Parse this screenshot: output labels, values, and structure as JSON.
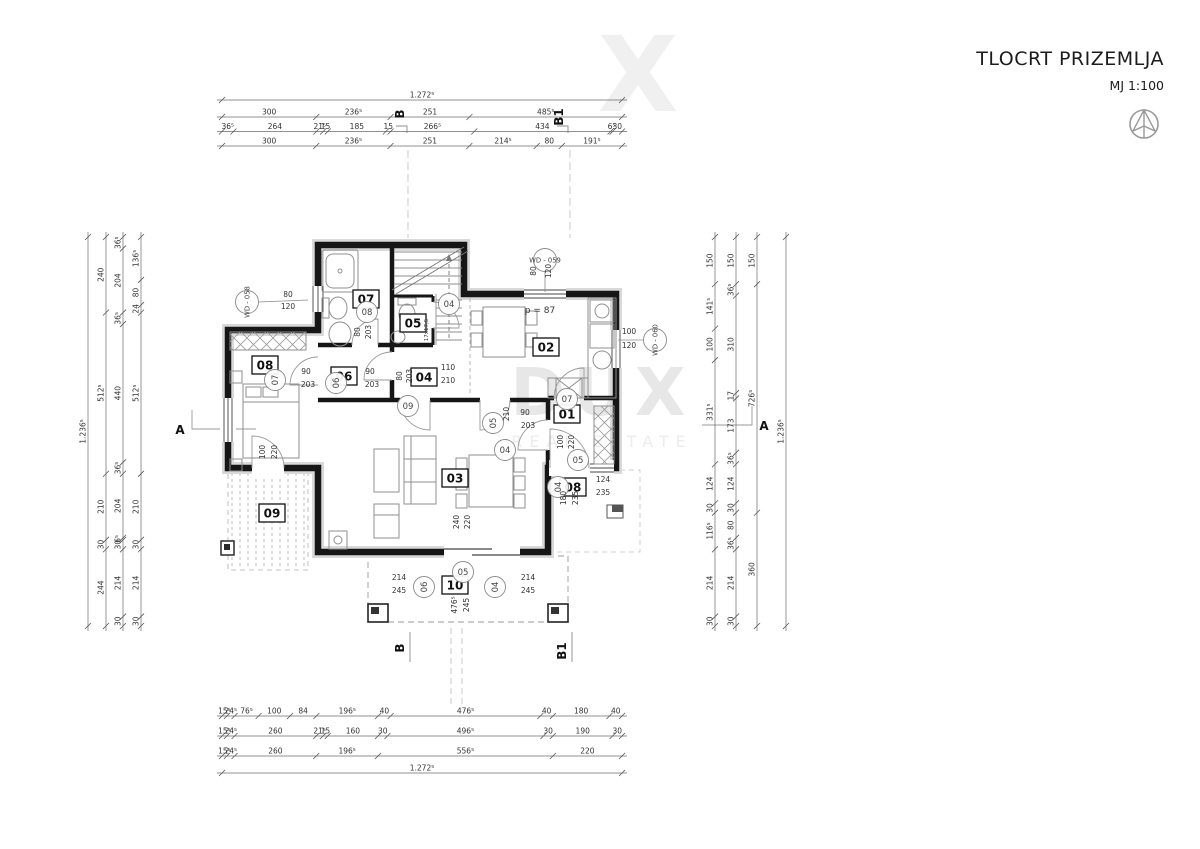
{
  "title_block": {
    "title": "TLOCRT PRIZEMLJA",
    "scale": "MJ 1:100"
  },
  "watermark": {
    "main": "DUX",
    "sub": "REAL ESTATE",
    "fragment": "X"
  },
  "dimension_lines": {
    "top": [
      {
        "segments": [
          "1.272⁵"
        ]
      },
      {
        "segments": [
          "300",
          "236⁵",
          "251",
          "485⁵"
        ]
      },
      {
        "segments": [
          "36⁵",
          "264",
          "21⁵",
          "15",
          "185",
          "15",
          "266⁵",
          "434",
          "6⁵",
          "30"
        ]
      },
      {
        "segments": [
          "300",
          "236⁵",
          "251",
          "214⁵",
          "80",
          "191⁵"
        ]
      }
    ],
    "bottom": [
      {
        "segments": [
          "15⁵",
          "24⁵",
          "76⁵",
          "100",
          "84",
          "196⁵",
          "40",
          "476⁵",
          "40",
          "180",
          "40"
        ]
      },
      {
        "segments": [
          "15⁵",
          "24⁵",
          "260",
          "21⁵",
          "15",
          "160",
          "30",
          "496⁵",
          "30",
          "190",
          "30"
        ]
      },
      {
        "segments": [
          "15⁵",
          "24⁵",
          "260",
          "196⁵",
          "556⁵",
          "220"
        ]
      },
      {
        "segments": [
          "1.272⁵"
        ]
      }
    ],
    "left": [
      {
        "segments": [
          "1.236⁵"
        ]
      },
      {
        "segments": [
          "240",
          "512⁵",
          "210",
          "30",
          "244"
        ]
      },
      {
        "segments": [
          "36⁵",
          "204",
          "36⁵",
          "440",
          "36⁵",
          "204",
          "6⁵",
          "30",
          "214",
          "30"
        ]
      },
      {
        "segments": [
          "136⁵",
          "80",
          "24",
          "512⁵",
          "210",
          "30",
          "214",
          "30"
        ]
      }
    ],
    "right": [
      {
        "segments": [
          "150",
          "141⁵",
          "100",
          "331⁵",
          "124",
          "30",
          "116⁵",
          "214",
          "30"
        ]
      },
      {
        "segments": [
          "150",
          "36⁵",
          "310",
          "17",
          "173",
          "36⁵",
          "124",
          "30",
          "80",
          "36⁵",
          "214",
          "30"
        ]
      },
      {
        "segments": [
          "150",
          "726⁵",
          "360"
        ]
      },
      {
        "segments": [
          "1.236⁵"
        ]
      }
    ]
  },
  "section_markers": [
    {
      "label": "A",
      "x": 180,
      "y": 434,
      "rot": 0
    },
    {
      "label": "A",
      "x": 764,
      "y": 430,
      "rot": 0
    },
    {
      "label": "B",
      "x": 404,
      "y": 114,
      "rot": -90
    },
    {
      "label": "B1",
      "x": 563,
      "y": 117,
      "rot": -90
    },
    {
      "label": "B",
      "x": 404,
      "y": 648,
      "rot": -90
    },
    {
      "label": "B1",
      "x": 566,
      "y": 651,
      "rot": -90
    }
  ],
  "room_labels": [
    {
      "id": "01",
      "x": 567,
      "y": 414
    },
    {
      "id": "02",
      "x": 546,
      "y": 347
    },
    {
      "id": "03",
      "x": 455,
      "y": 478
    },
    {
      "id": "04",
      "x": 424,
      "y": 377
    },
    {
      "id": "05",
      "x": 413,
      "y": 323
    },
    {
      "id": "06",
      "x": 344,
      "y": 376
    },
    {
      "id": "07",
      "x": 366,
      "y": 299
    },
    {
      "id": "08",
      "x": 265,
      "y": 365
    },
    {
      "id": "08",
      "x": 573,
      "y": 487
    },
    {
      "id": "09",
      "x": 272,
      "y": 513
    },
    {
      "id": "10",
      "x": 455,
      "y": 585
    }
  ],
  "door_markers": [
    {
      "label": "08",
      "x": 367,
      "y": 312,
      "rot": 0
    },
    {
      "label": "07",
      "x": 275,
      "y": 380,
      "rot": -90
    },
    {
      "label": "06",
      "x": 336,
      "y": 383,
      "rot": -90
    },
    {
      "label": "04",
      "x": 449,
      "y": 304,
      "rot": 0
    },
    {
      "label": "09",
      "x": 408,
      "y": 406,
      "rot": 0
    },
    {
      "label": "05",
      "x": 493,
      "y": 423,
      "rot": -90
    },
    {
      "label": "04",
      "x": 505,
      "y": 450,
      "rot": 0
    },
    {
      "label": "07",
      "x": 567,
      "y": 399,
      "rot": 0
    },
    {
      "label": "04",
      "x": 558,
      "y": 487,
      "rot": -90
    },
    {
      "label": "05",
      "x": 578,
      "y": 460,
      "rot": 0
    },
    {
      "label": "05",
      "x": 463,
      "y": 572,
      "rot": 0
    },
    {
      "label": "06",
      "x": 424,
      "y": 587,
      "rot": -90
    },
    {
      "label": "04",
      "x": 495,
      "y": 587,
      "rot": -90
    }
  ],
  "window_markers": [
    {
      "label": "WD - 058",
      "cx": 247,
      "cy": 302,
      "rot": -90,
      "leader": [
        259,
        302,
        308,
        300
      ]
    },
    {
      "label": "WD - 059",
      "cx": 545,
      "cy": 260,
      "rot": 0,
      "leader": [
        545,
        271,
        545,
        292
      ]
    },
    {
      "label": "WD - 060",
      "cx": 655,
      "cy": 340,
      "rot": -90,
      "leader": [
        618,
        340,
        644,
        340
      ]
    }
  ],
  "dim_notes": [
    {
      "t": "80",
      "x": 288,
      "y": 297,
      "rot": 0
    },
    {
      "t": "120",
      "x": 288,
      "y": 309,
      "rot": 0
    },
    {
      "t": "80",
      "x": 536,
      "y": 271,
      "rot": -90
    },
    {
      "t": "120",
      "x": 551,
      "y": 271,
      "rot": -90
    },
    {
      "t": "100",
      "x": 629,
      "y": 334,
      "rot": 0
    },
    {
      "t": "120",
      "x": 629,
      "y": 348,
      "rot": 0
    },
    {
      "t": "80",
      "x": 360,
      "y": 332,
      "rot": -90
    },
    {
      "t": "203",
      "x": 371,
      "y": 332,
      "rot": -90
    },
    {
      "t": "90",
      "x": 306,
      "y": 374,
      "rot": 0
    },
    {
      "t": "203",
      "x": 308,
      "y": 387,
      "rot": 0
    },
    {
      "t": "90",
      "x": 370,
      "y": 374,
      "rot": 0
    },
    {
      "t": "203",
      "x": 372,
      "y": 387,
      "rot": 0
    },
    {
      "t": "80",
      "x": 402,
      "y": 376,
      "rot": -90
    },
    {
      "t": "203",
      "x": 412,
      "y": 376,
      "rot": -90
    },
    {
      "t": "110",
      "x": 448,
      "y": 370,
      "rot": 0
    },
    {
      "t": "210",
      "x": 448,
      "y": 383,
      "rot": 0
    },
    {
      "t": "210",
      "x": 509,
      "y": 414,
      "rot": -90
    },
    {
      "t": "90",
      "x": 525,
      "y": 415,
      "rot": 0
    },
    {
      "t": "203",
      "x": 528,
      "y": 428,
      "rot": 0
    },
    {
      "t": "100",
      "x": 563,
      "y": 442,
      "rot": -90
    },
    {
      "t": "220",
      "x": 574,
      "y": 442,
      "rot": -90
    },
    {
      "t": "124",
      "x": 603,
      "y": 482,
      "rot": 0
    },
    {
      "t": "235",
      "x": 603,
      "y": 495,
      "rot": 0
    },
    {
      "t": "180",
      "x": 566,
      "y": 498,
      "rot": -90
    },
    {
      "t": "235",
      "x": 578,
      "y": 498,
      "rot": -90
    },
    {
      "t": "240",
      "x": 459,
      "y": 522,
      "rot": -90
    },
    {
      "t": "220",
      "x": 470,
      "y": 522,
      "rot": -90
    },
    {
      "t": "100",
      "x": 265,
      "y": 452,
      "rot": -90
    },
    {
      "t": "220",
      "x": 277,
      "y": 452,
      "rot": -90
    },
    {
      "t": "214",
      "x": 399,
      "y": 580,
      "rot": 0
    },
    {
      "t": "245",
      "x": 399,
      "y": 593,
      "rot": 0
    },
    {
      "t": "214",
      "x": 528,
      "y": 580,
      "rot": 0
    },
    {
      "t": "245",
      "x": 528,
      "y": 593,
      "rot": 0
    },
    {
      "t": "476⁵",
      "x": 457,
      "y": 605,
      "rot": -90
    },
    {
      "t": "245",
      "x": 469,
      "y": 605,
      "rot": -90
    }
  ],
  "text_notes": [
    {
      "t": "p = 87",
      "x": 540,
      "y": 313,
      "rot": 0,
      "size": 9
    },
    {
      "t": "17x17,5",
      "x": 428,
      "y": 330,
      "rot": -90,
      "size": 5.5
    }
  ]
}
